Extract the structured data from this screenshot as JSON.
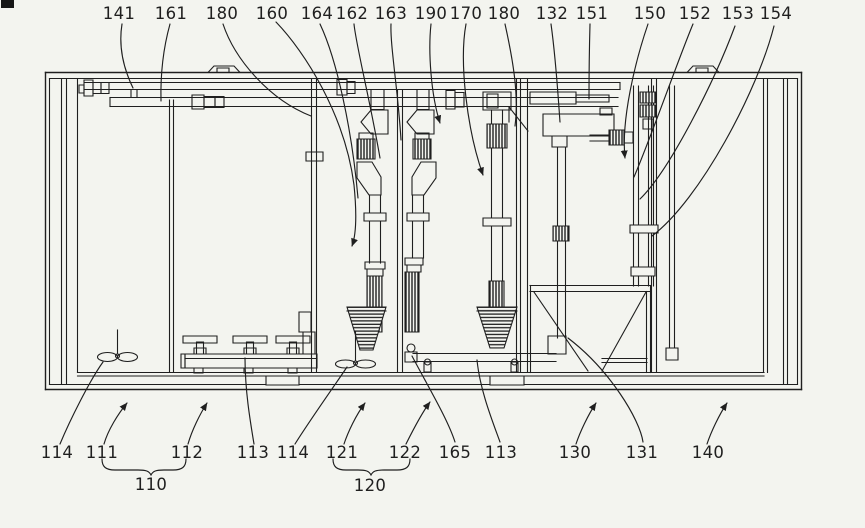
{
  "figure": {
    "kind": "patent-line-drawing",
    "colors": {
      "ink": "#1f1f1f",
      "background": "#f3f4ef"
    }
  },
  "labels": {
    "top": [
      {
        "text": "141"
      },
      {
        "text": "161"
      },
      {
        "text": "180"
      },
      {
        "text": "160"
      },
      {
        "text": "164"
      },
      {
        "text": "162"
      },
      {
        "text": "163"
      },
      {
        "text": "190"
      },
      {
        "text": "170"
      },
      {
        "text": "180"
      },
      {
        "text": "132"
      },
      {
        "text": "151"
      },
      {
        "text": "150"
      },
      {
        "text": "152"
      },
      {
        "text": "153"
      },
      {
        "text": "154"
      }
    ],
    "bottom": [
      {
        "text": "114"
      },
      {
        "text": "111"
      },
      {
        "text": "112"
      },
      {
        "text": "113"
      },
      {
        "text": "114"
      },
      {
        "text": "121"
      },
      {
        "text": "122"
      },
      {
        "text": "165"
      },
      {
        "text": "113"
      },
      {
        "text": "130"
      },
      {
        "text": "131"
      },
      {
        "text": "140"
      }
    ],
    "groups": [
      {
        "text": "110"
      },
      {
        "text": "120"
      }
    ]
  }
}
